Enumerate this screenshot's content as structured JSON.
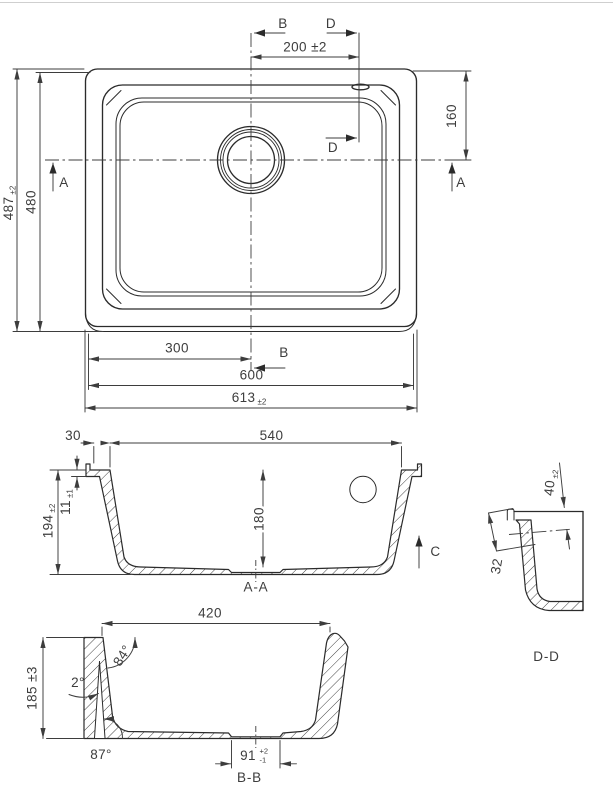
{
  "plan": {
    "section_b": "B",
    "section_d": "D",
    "section_a": "A",
    "dim_drain_offset_x": "200 ±2",
    "dim_drain_offset_y": "160",
    "dim_overall_depth": "487",
    "dim_overall_depth_tol": "±2",
    "dim_body_depth": "480",
    "dim_drain_from_left": "300",
    "dim_body_width": "600",
    "dim_overall_width": "613",
    "dim_overall_width_tol": "±2"
  },
  "section_aa": {
    "label": "A-A",
    "dim_flange_width": "30",
    "dim_bowl_width": "540",
    "dim_rim_step": "11",
    "dim_rim_step_tol": "±1",
    "dim_overall_height": "194",
    "dim_overall_height_tol": "±2",
    "dim_bowl_depth": "180",
    "section_c": "C"
  },
  "section_dd": {
    "label": "D-D",
    "dim_rim_width": "40",
    "dim_rim_width_tol": "±2",
    "dim_edge_height": "32"
  },
  "section_bb": {
    "label": "B-B",
    "dim_bowl_width": "420",
    "dim_overall_height": "185 ±3",
    "angle_wall": "84°",
    "angle_draft": "2°",
    "angle_base": "87°",
    "dim_recess_width": "91",
    "dim_recess_tol_plus": "+2",
    "dim_recess_tol_minus": "-1"
  },
  "colors": {
    "line": "#2b2b2b",
    "dimension": "#3d3d3d",
    "background": "#ffffff"
  }
}
